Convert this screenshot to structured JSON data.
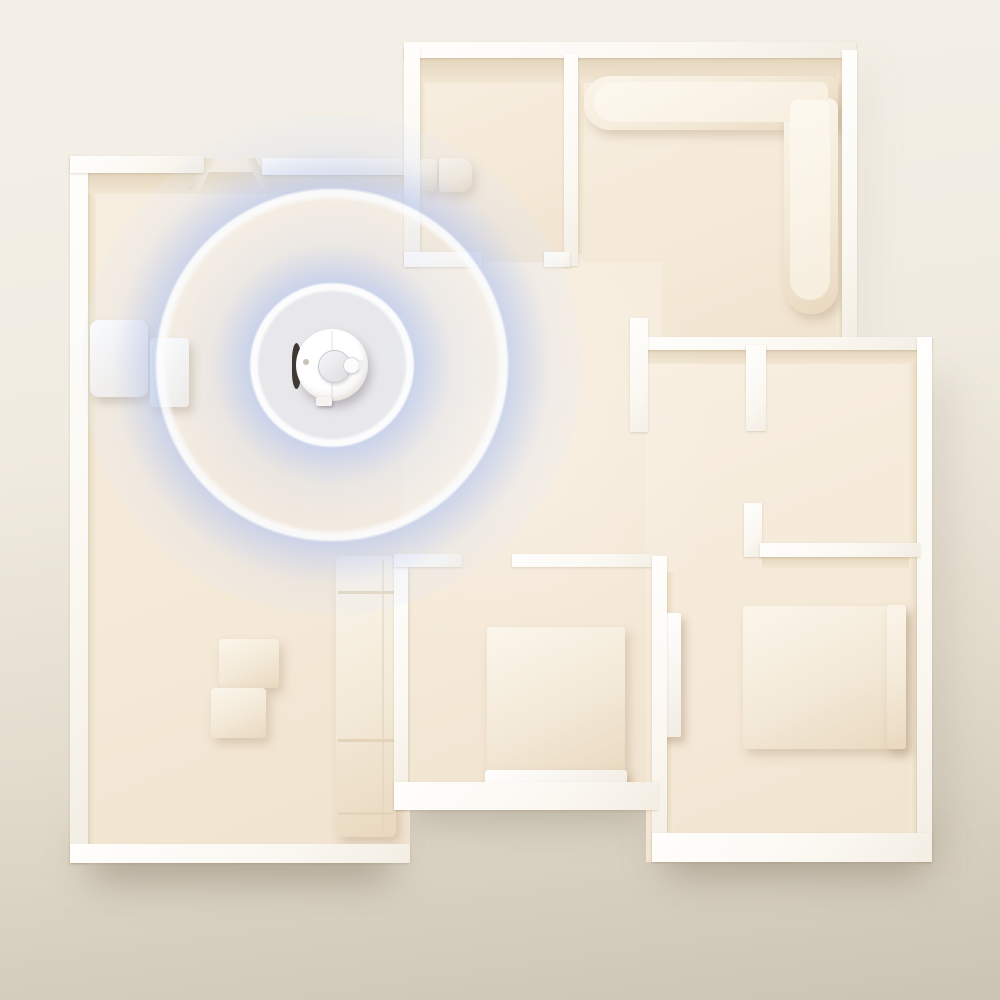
{
  "meta": {
    "scene": "Top-down 3D render of a cream apartment floor plan; a round white robot vacuum in the upper-left living room emits concentric blue LiDAR mapping rings; a white charging dock sits against the left wall; rooms contain white furniture (L-shaped sectional sofa, beds, coffee tables, cabinets).",
    "visible_text": []
  },
  "colors": {
    "background_top": "#f4f0e8",
    "background_bottom": "#c9c1b1",
    "floor": "#f5ebdb",
    "wall_top": "#fefdfb",
    "wall_shadow_face": "#e8dabf",
    "furniture": "#f7f0e3",
    "lidar_ring_blue": "#bdcbe9",
    "lidar_ring_edge": "#fdfeff",
    "robot_body": "#fafafa",
    "robot_bumper": "#3d3833"
  },
  "robot": {
    "center_x": 332,
    "center_y": 365,
    "body_diameter": 72,
    "lidar_turret_diameter": 31,
    "heading": "east"
  },
  "lidar_rings": {
    "center_x": 332,
    "center_y": 365,
    "ring_edge_radii_px": [
      55,
      123,
      193
    ],
    "outer_fade_radius_px": 235
  },
  "scene": {
    "layers": [
      {
        "name": "shadows",
        "items": [
          {
            "n": "drop-shadow-bottom-left",
            "cls": "sh",
            "x": 90,
            "y": 835,
            "w": 300,
            "h": 45,
            "bg": "rgba(110,96,76,0.42)"
          },
          {
            "n": "drop-shadow-bottom-mid",
            "cls": "sh",
            "x": 410,
            "y": 780,
            "w": 240,
            "h": 38,
            "bg": "rgba(110,96,76,0.35)"
          },
          {
            "n": "drop-shadow-bottom-right",
            "cls": "sh",
            "x": 665,
            "y": 828,
            "w": 260,
            "h": 45,
            "bg": "rgba(110,96,76,0.42)"
          },
          {
            "n": "drop-shadow-right-wall",
            "cls": "sh",
            "x": 922,
            "y": 380,
            "w": 22,
            "h": 460,
            "bg": "rgba(115,100,80,0.22)"
          },
          {
            "n": "drop-shadow-top-block",
            "cls": "sh",
            "x": 850,
            "y": 70,
            "w": 14,
            "h": 270,
            "bg": "rgba(115,100,80,0.15)"
          }
        ]
      },
      {
        "name": "floors",
        "items": [
          {
            "n": "living-room-floor",
            "cls": "floor",
            "x": 78,
            "y": 160,
            "w": 332,
            "h": 700
          },
          {
            "n": "top-middle-room-floor",
            "cls": "floor",
            "x": 410,
            "y": 54,
            "w": 162,
            "h": 212
          },
          {
            "n": "top-right-room-floor",
            "cls": "floor",
            "x": 570,
            "y": 52,
            "w": 282,
            "h": 294
          },
          {
            "n": "hallway-floor",
            "cls": "floor",
            "x": 402,
            "y": 262,
            "w": 260,
            "h": 548
          },
          {
            "n": "right-wing-floor",
            "cls": "floor",
            "x": 646,
            "y": 342,
            "w": 286,
            "h": 520
          }
        ]
      },
      {
        "name": "faces",
        "items": [
          {
            "n": "living-room-north-wall-face",
            "cls": "face",
            "x": 88,
            "y": 172,
            "w": 324,
            "h": 22
          },
          {
            "n": "top-middle-room-north-wall-face",
            "cls": "face",
            "x": 418,
            "y": 57,
            "w": 150,
            "h": 26
          },
          {
            "n": "top-right-room-north-wall-face",
            "cls": "face",
            "x": 577,
            "y": 57,
            "w": 266,
            "h": 26
          },
          {
            "n": "right-wing-north-wall-face",
            "cls": "face",
            "x": 646,
            "y": 349,
            "w": 274,
            "h": 15
          },
          {
            "n": "bottom-right-room-north-wall-face",
            "cls": "face",
            "x": 762,
            "y": 556,
            "w": 152,
            "h": 12
          },
          {
            "n": "living-room-west-wall-face",
            "cls": "facev",
            "x": 88,
            "y": 193,
            "w": 8,
            "h": 652
          },
          {
            "n": "top-middle-room-west-wall-face",
            "cls": "facev",
            "x": 418,
            "y": 82,
            "w": 7,
            "h": 172
          },
          {
            "n": "top-right-room-west-wall-face",
            "cls": "facev",
            "x": 577,
            "y": 82,
            "w": 7,
            "h": 172
          },
          {
            "n": "top-right-room-east-wall-face",
            "cls": "facew",
            "x": 836,
            "y": 76,
            "w": 8,
            "h": 266
          },
          {
            "n": "right-wing-east-wall-face",
            "cls": "facew",
            "x": 909,
            "y": 362,
            "w": 9,
            "h": 486
          },
          {
            "n": "middle-room-west-wall-face",
            "cls": "facev",
            "x": 406,
            "y": 570,
            "w": 7,
            "h": 212
          },
          {
            "n": "bottom-right-room-west-wall-face",
            "cls": "facev",
            "x": 667,
            "y": 572,
            "w": 7,
            "h": 260
          },
          {
            "n": "entry-door-jamb-left",
            "cls": "facev",
            "x": 196,
            "y": 158,
            "w": 12,
            "h": 32,
            "tf": "skewX(-28deg)"
          },
          {
            "n": "entry-door-jamb-right",
            "cls": "facew",
            "x": 254,
            "y": 158,
            "w": 10,
            "h": 32,
            "tf": "skewX(28deg)"
          }
        ]
      },
      {
        "name": "furniture",
        "items": [
          {
            "n": "sectional-sofa-back-horizontal",
            "cls": "furn",
            "x": 584,
            "y": 76,
            "w": 254,
            "h": 54,
            "rad": "26px 10px 10px 26px"
          },
          {
            "n": "sectional-sofa-back-vertical",
            "cls": "furn",
            "x": 784,
            "y": 98,
            "w": 54,
            "h": 216,
            "rad": "10px 10px 26px 26px"
          },
          {
            "n": "sectional-sofa-seat-horizontal",
            "cls": "furnlight",
            "x": 594,
            "y": 82,
            "w": 234,
            "h": 40,
            "rad": "20px 8px 8px 20px"
          },
          {
            "n": "sectional-sofa-seat-vertical",
            "cls": "furnlight",
            "x": 790,
            "y": 100,
            "w": 40,
            "h": 200,
            "rad": "8px 8px 20px 20px"
          },
          {
            "n": "bathroom-cabinet-left",
            "cls": "furn",
            "x": 420,
            "y": 159,
            "w": 17,
            "h": 32,
            "rad": "3px"
          },
          {
            "n": "bathroom-cabinet-right",
            "cls": "furn",
            "x": 439,
            "y": 158,
            "w": 33,
            "h": 34,
            "rad": "4px 12px 12px 4px"
          },
          {
            "n": "charging-dock",
            "cls": "furnwhite",
            "x": 90,
            "y": 320,
            "w": 58,
            "h": 77,
            "rad": "9px"
          },
          {
            "n": "charging-dock-ramp",
            "cls": "furnwhite",
            "x": 150,
            "y": 338,
            "w": 39,
            "h": 69,
            "rad": "4px"
          },
          {
            "n": "coffee-table-upper",
            "cls": "furn",
            "x": 219,
            "y": 639,
            "w": 60,
            "h": 49,
            "rad": "4px"
          },
          {
            "n": "coffee-table-lower",
            "cls": "furn",
            "x": 211,
            "y": 688,
            "w": 55,
            "h": 50,
            "rad": "4px"
          },
          {
            "n": "living-room-sofa",
            "cls": "furn",
            "x": 336,
            "y": 556,
            "w": 60,
            "h": 281,
            "rad": "6px"
          },
          {
            "n": "living-room-sofa-seam-1",
            "cls": "seam",
            "x": 338,
            "y": 591,
            "w": 56,
            "h": 3
          },
          {
            "n": "living-room-sofa-seam-2",
            "cls": "seam",
            "x": 338,
            "y": 739,
            "w": 56,
            "h": 3
          },
          {
            "n": "living-room-sofa-seam-3",
            "cls": "seam",
            "x": 338,
            "y": 812,
            "w": 56,
            "h": 3
          },
          {
            "n": "living-room-sofa-back-line",
            "cls": "seam",
            "x": 382,
            "y": 560,
            "w": 2,
            "h": 274,
            "op": "0.6"
          },
          {
            "n": "bed-middle-room",
            "cls": "furn",
            "x": 487,
            "y": 627,
            "w": 138,
            "h": 152,
            "rad": "3px"
          },
          {
            "n": "bed-middle-room-footboard",
            "cls": "furnwhite",
            "x": 485,
            "y": 770,
            "w": 142,
            "h": 19,
            "rad": "3px"
          },
          {
            "n": "bed-right-room",
            "cls": "furn",
            "x": 743,
            "y": 606,
            "w": 163,
            "h": 143,
            "rad": "3px"
          },
          {
            "n": "bed-right-room-headboard",
            "cls": "furn",
            "x": 887,
            "y": 605,
            "w": 19,
            "h": 144,
            "rad": "3px"
          },
          {
            "n": "wardrobe-panel",
            "cls": "furnwhite",
            "x": 660,
            "y": 613,
            "w": 21,
            "h": 124,
            "rad": "2px"
          }
        ]
      },
      {
        "name": "walls",
        "items": [
          {
            "n": "wall-left-outer",
            "cls": "wall",
            "x": 70,
            "y": 156,
            "w": 18,
            "h": 707
          },
          {
            "n": "wall-living-top-left",
            "cls": "wall",
            "x": 70,
            "y": 156,
            "w": 134,
            "h": 17
          },
          {
            "n": "wall-living-top-right",
            "cls": "wall",
            "x": 262,
            "y": 158,
            "w": 150,
            "h": 17
          },
          {
            "n": "wall-living-bottom",
            "cls": "wall",
            "x": 70,
            "y": 844,
            "w": 340,
            "h": 19
          },
          {
            "n": "wall-top-outer",
            "cls": "wall",
            "x": 404,
            "y": 42,
            "w": 452,
            "h": 16
          },
          {
            "n": "wall-top-block-left",
            "cls": "wall",
            "x": 404,
            "y": 48,
            "w": 16,
            "h": 218
          },
          {
            "n": "wall-top-room-divider",
            "cls": "wall",
            "x": 564,
            "y": 54,
            "w": 14,
            "h": 212
          },
          {
            "n": "wall-top-block-right",
            "cls": "wall",
            "x": 842,
            "y": 50,
            "w": 15,
            "h": 296
          },
          {
            "n": "wall-top-middle-stub-left",
            "cls": "wall",
            "x": 404,
            "y": 252,
            "w": 78,
            "h": 15
          },
          {
            "n": "wall-top-middle-stub-right",
            "cls": "wall",
            "x": 544,
            "y": 252,
            "w": 26,
            "h": 15
          },
          {
            "n": "wall-right-wing-top",
            "cls": "wall",
            "x": 636,
            "y": 337,
            "w": 296,
            "h": 13
          },
          {
            "n": "wall-right-wing-left-stub",
            "cls": "wall",
            "x": 630,
            "y": 318,
            "w": 18,
            "h": 114
          },
          {
            "n": "wall-closet-divider-stub",
            "cls": "wall",
            "x": 746,
            "y": 345,
            "w": 20,
            "h": 86
          },
          {
            "n": "wall-right-outer",
            "cls": "wall",
            "x": 917,
            "y": 337,
            "w": 15,
            "h": 525
          },
          {
            "n": "wall-l-vertical",
            "cls": "wall",
            "x": 744,
            "y": 503,
            "w": 18,
            "h": 54
          },
          {
            "n": "wall-l-horizontal",
            "cls": "wall",
            "x": 760,
            "y": 543,
            "w": 160,
            "h": 14
          },
          {
            "n": "wall-middle-room-left",
            "cls": "wall",
            "x": 394,
            "y": 556,
            "w": 14,
            "h": 254
          },
          {
            "n": "wall-middle-room-stub-a",
            "cls": "wall",
            "x": 394,
            "y": 554,
            "w": 68,
            "h": 13
          },
          {
            "n": "wall-middle-room-stub-b",
            "cls": "wall",
            "x": 512,
            "y": 554,
            "w": 148,
            "h": 13
          },
          {
            "n": "wall-bottom-right-room-left",
            "cls": "wall",
            "x": 652,
            "y": 556,
            "w": 15,
            "h": 305
          },
          {
            "n": "wall-middle-room-bottom",
            "cls": "wall",
            "x": 394,
            "y": 782,
            "w": 264,
            "h": 28
          },
          {
            "n": "wall-bottom-right-bottom",
            "cls": "wall",
            "x": 652,
            "y": 833,
            "w": 280,
            "h": 29
          }
        ]
      },
      {
        "name": "lighting",
        "items": [
          {
            "n": "room-highlight",
            "x": 250,
            "y": 200,
            "w": 500,
            "h": 500,
            "bg": "radial-gradient(circle, rgba(255,255,255,0.25), rgba(255,255,255,0) 65%)"
          }
        ]
      }
    ]
  }
}
